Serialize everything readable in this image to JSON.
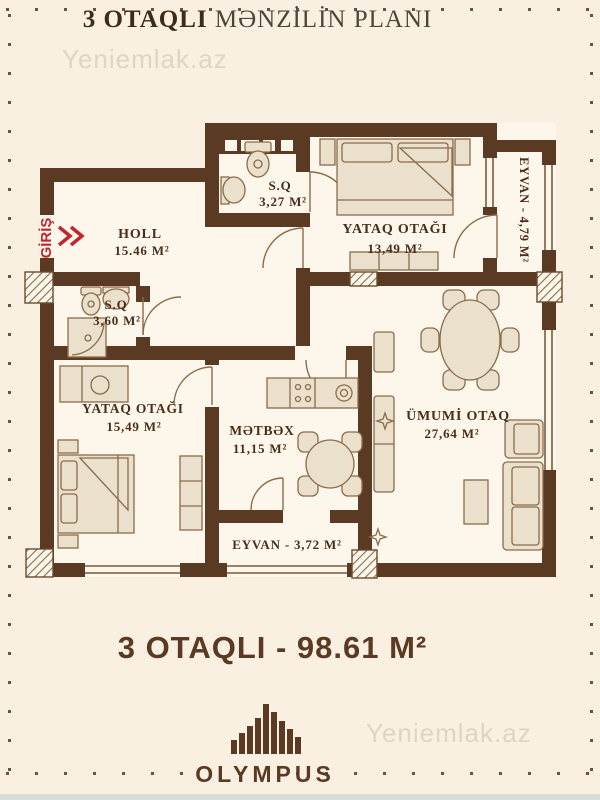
{
  "title": {
    "bold": "3 OTAQLI",
    "regular": " MƏNZİLİN PLANI"
  },
  "watermark": "Yeniemlak.az",
  "entrance": {
    "label": "GİRİŞ"
  },
  "rooms": {
    "holl": {
      "name": "HOLL",
      "area": "15.46 M²"
    },
    "sq_top": {
      "name": "S.Q",
      "area": "3,27 M²"
    },
    "bedroom_top": {
      "name": "YATAQ OTAĞI",
      "area": "13,49 M²"
    },
    "eyvan_right": {
      "label": "EYVAN - 4,79 M²"
    },
    "sq_left": {
      "name": "S.Q",
      "area": "3,60 M²"
    },
    "bedroom_left": {
      "name": "YATAQ OTAĞI",
      "area": "15,49 M²"
    },
    "kitchen": {
      "name": "MƏTBƏX",
      "area": "11,15 M²"
    },
    "living": {
      "name": "ÜMUMİ OTAQ",
      "area": "27,64 M²"
    },
    "eyvan_bottom": {
      "label": "EYVAN - 3,72 M²"
    }
  },
  "footer": {
    "summary": "3 OTAQLI - 98.61 M²",
    "brand": "OLYMPUS"
  },
  "colors": {
    "wall": "#5b3a23",
    "accent_red": "#c2242b",
    "background": "#faf0e1",
    "floor": "#fcf7ea",
    "furniture_fill": "#eae0cb",
    "furniture_stroke": "#8a6b4b",
    "label_text": "#4a2d1a",
    "watermark": "#ccc5b8"
  }
}
